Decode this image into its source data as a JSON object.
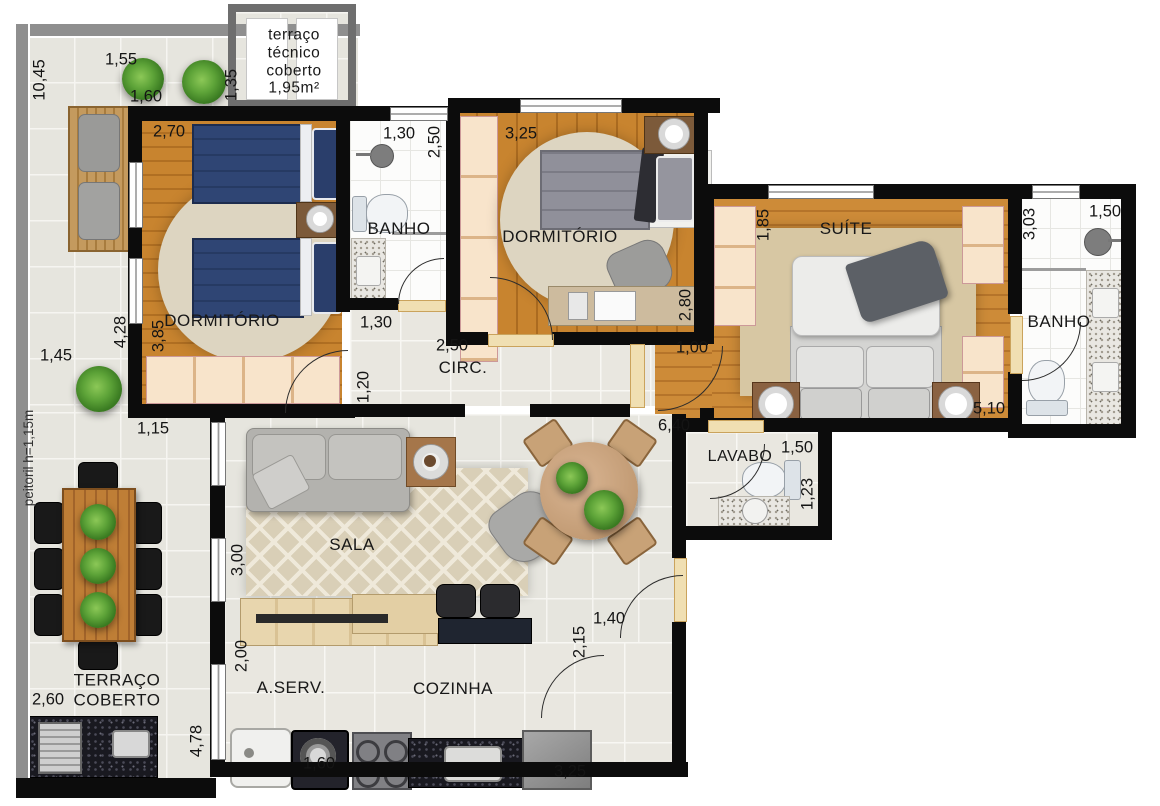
{
  "rooms": {
    "tecnico": "terraço\ntécnico\ncoberto\n1,95m²",
    "dorm1": "DORMITÓRIO",
    "banho1": "BANHO",
    "dorm2": "DORMITÓRIO",
    "suite": "SUÍTE",
    "banho2": "BANHO",
    "circ": "CIRC.",
    "sala": "SALA",
    "lavabo": "LAVABO",
    "terraco": "TERRAÇO\nCOBERTO",
    "aserv": "A.SERV.",
    "cozinha": "COZINHA"
  },
  "notes": {
    "peitoril": "peitoril h=1,15m"
  },
  "dims": {
    "terr_height": "10,45",
    "terr_top": "1,55",
    "terr_gap": "1,60",
    "terr_135": "1,35",
    "dorm1_w": "2,70",
    "banho1_w": "1,30",
    "banho1_h": "2,50",
    "dorm2_w": "3,25",
    "suite_ward": "1,85",
    "banho2_h": "3,03",
    "banho2_w": "1,50",
    "terr_145": "1,45",
    "dorm1_tot": "4,28",
    "dorm1_h": "3,85",
    "circ_130": "1,30",
    "circ_w": "2,50",
    "circ_h": "1,20",
    "dorm2_h": "2,80",
    "suite_door": "1,00",
    "suite_w": "5,10",
    "terr_115": "1,15",
    "sala_w": "6,40",
    "lavabo_w": "1,50",
    "lavabo_h": "1,23",
    "sala_h": "3,00",
    "terr_260": "2,60",
    "aserv_h": "2,00",
    "entry_h": "2,15",
    "entry_w": "1,40",
    "terr_478": "4,78",
    "washer_w": "1,60",
    "fridge_w": "3,25"
  }
}
